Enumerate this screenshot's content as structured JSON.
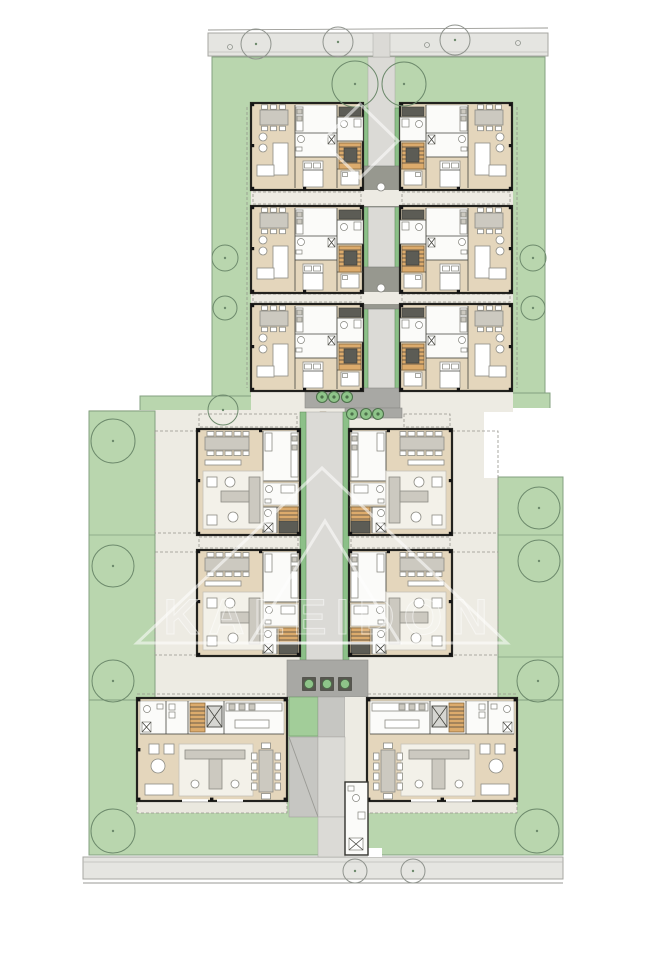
{
  "meta": {
    "title": "Residential complex site plan — ground floor",
    "canvas": {
      "w": 659,
      "h": 960
    }
  },
  "palette": {
    "road": "#e5e5e1",
    "green": "#b9d6ae",
    "trough": "#8cc088",
    "cream": "#edebe3",
    "floor": "#e4d6bc",
    "stair": "#dcab6c",
    "wall": "#22221e",
    "watermark_white": "#ffffff"
  },
  "watermark": {
    "text": "KALEIDON",
    "rhombus": "360,104 398,141 360,178 322,141",
    "triangle_outer": "322,468 507,643 137,643",
    "triangle_inner": "325,521 400,643 250,643",
    "text_x": 330,
    "text_y": 634,
    "font_size": 50,
    "letter_spacing": 9
  },
  "site": {
    "unit_types": {
      "A": {
        "w": 112,
        "h": 87
      },
      "B": {
        "w": 103,
        "h": 106
      },
      "C": {
        "w": 150,
        "h": 103
      }
    },
    "shapes": [
      {
        "t": "line",
        "x1": 208,
        "y1": 30,
        "x2": 548,
        "y2": 28,
        "c": "line",
        "n": "street-edge-top"
      },
      {
        "t": "rect",
        "x": 208,
        "y": 33,
        "w": 340,
        "h": 23,
        "c": "road",
        "n": "sidewalk-top"
      },
      {
        "t": "line",
        "x1": 208,
        "y1": 52,
        "x2": 548,
        "y2": 52,
        "c": "roadline",
        "n": "curb-top"
      },
      {
        "t": "rect",
        "x": 83,
        "y": 857,
        "w": 480,
        "h": 22,
        "c": "road",
        "n": "sidewalk-bottom"
      },
      {
        "t": "line",
        "x1": 83,
        "y1": 862,
        "x2": 563,
        "y2": 862,
        "c": "roadline",
        "n": "curb-bottom"
      },
      {
        "t": "line",
        "x1": 83,
        "y1": 883,
        "x2": 563,
        "y2": 883,
        "c": "line",
        "n": "street-edge-bottom"
      },
      {
        "t": "rect",
        "x": 212,
        "y": 57,
        "w": 333,
        "h": 351,
        "c": "green",
        "n": "garden-top-block"
      },
      {
        "t": "rect",
        "x": 140,
        "y": 396,
        "w": 112,
        "h": 28,
        "c": "green",
        "n": "garden-patch-left"
      },
      {
        "t": "rect",
        "x": 492,
        "y": 393,
        "w": 58,
        "h": 16,
        "c": "green",
        "n": "garden-patch-right"
      },
      {
        "t": "rect",
        "x": 89,
        "y": 410,
        "w": 474,
        "h": 247,
        "c": "cream",
        "n": "court-middle-block"
      },
      {
        "t": "rect",
        "x": 484,
        "y": 408,
        "w": 80,
        "h": 70,
        "c": "white",
        "n": "site-notch-right"
      },
      {
        "t": "rect",
        "x": 137,
        "y": 657,
        "w": 380,
        "h": 43,
        "c": "cream",
        "n": "court-bottom-block"
      },
      {
        "t": "rect",
        "x": 89,
        "y": 411,
        "w": 66,
        "h": 444,
        "c": "green",
        "n": "garden-strip-left"
      },
      {
        "t": "rect",
        "x": 498,
        "y": 477,
        "w": 65,
        "h": 378,
        "c": "green",
        "n": "garden-strip-right"
      },
      {
        "t": "rect",
        "x": 89,
        "y": 700,
        "w": 474,
        "h": 155,
        "c": "green",
        "n": "garden-bottom-block"
      },
      {
        "t": "line",
        "x1": 498,
        "y1": 535,
        "x2": 563,
        "y2": 535,
        "c": "greenline",
        "n": "garden-divider"
      },
      {
        "t": "line",
        "x1": 498,
        "y1": 657,
        "x2": 563,
        "y2": 657,
        "c": "greenline",
        "n": "garden-divider"
      },
      {
        "t": "line",
        "x1": 89,
        "y1": 535,
        "x2": 155,
        "y2": 535,
        "c": "greenline",
        "n": "garden-divider"
      },
      {
        "t": "rect",
        "x": 368,
        "y": 57,
        "w": 27,
        "h": 339,
        "c": "walkL",
        "n": "corridor-top-walk"
      },
      {
        "t": "rect",
        "x": 373,
        "y": 33,
        "w": 17,
        "h": 24,
        "c": "walkL",
        "n": "entry-path-top"
      },
      {
        "t": "rect",
        "x": 363,
        "y": 108,
        "w": 5,
        "h": 283,
        "c": "trough",
        "n": "planting-trough"
      },
      {
        "t": "rect",
        "x": 395,
        "y": 108,
        "w": 5,
        "h": 283,
        "c": "trough",
        "n": "planting-trough"
      },
      {
        "t": "rect",
        "x": 363,
        "y": 166,
        "w": 37,
        "h": 41,
        "c": "dark",
        "n": "stair-landing"
      },
      {
        "t": "rect",
        "x": 363,
        "y": 267,
        "w": 37,
        "h": 42,
        "c": "dark",
        "n": "stair-landing"
      },
      {
        "t": "rect",
        "x": 251,
        "y": 190,
        "w": 262,
        "h": 16,
        "c": "cream",
        "n": "terrace-strip"
      },
      {
        "t": "rect",
        "x": 251,
        "y": 292,
        "w": 262,
        "h": 12,
        "c": "cream",
        "n": "terrace-strip"
      },
      {
        "t": "rect",
        "x": 251,
        "y": 391,
        "w": 262,
        "h": 21,
        "c": "cream",
        "n": "terrace-strip"
      },
      {
        "t": "rect",
        "x": 253,
        "y": 192,
        "w": 108,
        "h": 12,
        "c": "dash",
        "n": "terrace-outline"
      },
      {
        "t": "rect",
        "x": 402,
        "y": 192,
        "w": 108,
        "h": 12,
        "c": "dash",
        "n": "terrace-outline"
      },
      {
        "t": "rect",
        "x": 253,
        "y": 294,
        "w": 108,
        "h": 8,
        "c": "dash",
        "n": "terrace-outline"
      },
      {
        "t": "rect",
        "x": 402,
        "y": 294,
        "w": 108,
        "h": 8,
        "c": "dash",
        "n": "terrace-outline"
      },
      {
        "t": "line",
        "x1": 247,
        "y1": 107,
        "x2": 247,
        "y2": 388,
        "c": "dash",
        "n": "terrace-outline"
      },
      {
        "t": "line",
        "x1": 517,
        "y1": 107,
        "x2": 517,
        "y2": 388,
        "c": "dash",
        "n": "terrace-outline"
      },
      {
        "t": "rect",
        "x": 305,
        "y": 388,
        "w": 95,
        "h": 20,
        "c": "court",
        "n": "entry-plaza-upper"
      },
      {
        "t": "rect",
        "x": 345,
        "y": 408,
        "w": 57,
        "h": 10,
        "c": "court",
        "n": "entry-plaza-lower"
      },
      {
        "t": "rect",
        "x": 320,
        "y": 412,
        "w": 6,
        "h": 18,
        "c": "bench",
        "n": "bench"
      },
      {
        "t": "rect",
        "x": 306,
        "y": 412,
        "w": 37,
        "h": 248,
        "c": "walkL",
        "n": "corridor-middle-walk"
      },
      {
        "t": "rect",
        "x": 300,
        "y": 412,
        "w": 6,
        "h": 248,
        "c": "trough",
        "n": "planting-trough"
      },
      {
        "t": "rect",
        "x": 343,
        "y": 412,
        "w": 6,
        "h": 248,
        "c": "trough",
        "n": "planting-trough"
      },
      {
        "t": "rect",
        "x": 155,
        "y": 431,
        "w": 42,
        "h": 102,
        "c": "dash",
        "n": "terrace-outline"
      },
      {
        "t": "rect",
        "x": 155,
        "y": 552,
        "w": 42,
        "h": 103,
        "c": "dash",
        "n": "terrace-outline"
      },
      {
        "t": "rect",
        "x": 452,
        "y": 431,
        "w": 46,
        "h": 102,
        "c": "dash",
        "n": "terrace-outline"
      },
      {
        "t": "rect",
        "x": 452,
        "y": 552,
        "w": 46,
        "h": 103,
        "c": "dash",
        "n": "terrace-outline"
      },
      {
        "t": "rect",
        "x": 199,
        "y": 537,
        "w": 99,
        "h": 11,
        "c": "dash",
        "n": "terrace-outline"
      },
      {
        "t": "rect",
        "x": 351,
        "y": 537,
        "w": 99,
        "h": 11,
        "c": "dash",
        "n": "terrace-outline"
      },
      {
        "t": "rect",
        "x": 199,
        "y": 414,
        "w": 98,
        "h": 13,
        "c": "dash",
        "n": "terrace-outline"
      },
      {
        "t": "rect",
        "x": 404,
        "y": 414,
        "w": 46,
        "h": 13,
        "c": "dash",
        "n": "terrace-outline"
      },
      {
        "t": "rect",
        "x": 287,
        "y": 660,
        "w": 81,
        "h": 37,
        "c": "court",
        "n": "entry-plaza-bottom"
      },
      {
        "t": "rect",
        "x": 289,
        "y": 697,
        "w": 29,
        "h": 39,
        "c": "gsq",
        "n": "lawn-square"
      },
      {
        "t": "rect",
        "x": 318,
        "y": 697,
        "w": 27,
        "h": 40,
        "c": "walkM",
        "n": "core-paving"
      },
      {
        "t": "rect",
        "x": 345,
        "y": 697,
        "w": 23,
        "h": 85,
        "c": "cream",
        "n": "core-paving"
      },
      {
        "t": "rect",
        "x": 289,
        "y": 737,
        "w": 29,
        "h": 80,
        "c": "walkM",
        "n": "ramp"
      },
      {
        "t": "line",
        "x1": 289,
        "y1": 737,
        "x2": 318,
        "y2": 817,
        "c": "line",
        "n": "ramp-edge"
      },
      {
        "t": "rect",
        "x": 318,
        "y": 737,
        "w": 27,
        "h": 80,
        "c": "walkL",
        "n": "corridor-bottom-walk"
      },
      {
        "t": "rect",
        "x": 318,
        "y": 817,
        "w": 27,
        "h": 40,
        "c": "walkL",
        "n": "entry-path-bottom"
      },
      {
        "t": "rect",
        "x": 368,
        "y": 848,
        "w": 14,
        "h": 9,
        "c": "white",
        "n": "core-niche"
      },
      {
        "t": "rect",
        "x": 137,
        "y": 801,
        "w": 150,
        "h": 12,
        "c": "dashfill",
        "n": "terrace-outline"
      },
      {
        "t": "rect",
        "x": 368,
        "y": 801,
        "w": 149,
        "h": 12,
        "c": "dashfill",
        "n": "terrace-outline"
      },
      {
        "t": "line",
        "x1": 137,
        "y1": 694,
        "x2": 287,
        "y2": 694,
        "c": "dash",
        "n": "terrace-outline"
      },
      {
        "t": "line",
        "x1": 368,
        "y1": 694,
        "x2": 517,
        "y2": 694,
        "c": "dash",
        "n": "terrace-outline"
      },
      {
        "t": "circle",
        "cx": 381,
        "cy": 187,
        "r": 4,
        "c": "landing",
        "n": "skylight"
      },
      {
        "t": "circle",
        "cx": 381,
        "cy": 288,
        "r": 4,
        "c": "landing",
        "n": "skylight"
      }
    ],
    "units": [
      {
        "id": "a1-left",
        "type": "A",
        "x": 251,
        "y": 103,
        "m": false
      },
      {
        "id": "a1-right",
        "type": "A",
        "x": 400,
        "y": 103,
        "m": true
      },
      {
        "id": "a2-left",
        "type": "A",
        "x": 251,
        "y": 206,
        "m": false
      },
      {
        "id": "a2-right",
        "type": "A",
        "x": 400,
        "y": 206,
        "m": true
      },
      {
        "id": "a3-left",
        "type": "A",
        "x": 251,
        "y": 304,
        "m": false
      },
      {
        "id": "a3-right",
        "type": "A",
        "x": 400,
        "y": 304,
        "m": true
      },
      {
        "id": "b1-left",
        "type": "B",
        "x": 197,
        "y": 429,
        "m": false
      },
      {
        "id": "b1-right",
        "type": "B",
        "x": 349,
        "y": 429,
        "m": true
      },
      {
        "id": "b2-left",
        "type": "B",
        "x": 197,
        "y": 550,
        "m": false
      },
      {
        "id": "b2-right",
        "type": "B",
        "x": 349,
        "y": 550,
        "m": true
      },
      {
        "id": "c-left",
        "type": "C",
        "x": 137,
        "y": 698,
        "m": false
      },
      {
        "id": "c-right",
        "type": "C",
        "x": 367,
        "y": 698,
        "m": true
      }
    ],
    "techroom": {
      "x": 345,
      "y": 782
    },
    "trees": [
      {
        "x": 256,
        "y": 44,
        "r": 15,
        "kind": "road"
      },
      {
        "x": 338,
        "y": 42,
        "r": 15,
        "kind": "road"
      },
      {
        "x": 455,
        "y": 40,
        "r": 15,
        "kind": "road"
      },
      {
        "x": 355,
        "y": 871,
        "r": 12,
        "kind": "road"
      },
      {
        "x": 413,
        "y": 871,
        "r": 12,
        "kind": "road"
      },
      {
        "x": 355,
        "y": 84,
        "r": 23,
        "kind": "garden"
      },
      {
        "x": 404,
        "y": 84,
        "r": 22,
        "kind": "garden"
      },
      {
        "x": 225,
        "y": 258,
        "r": 13,
        "kind": "garden"
      },
      {
        "x": 533,
        "y": 258,
        "r": 13,
        "kind": "garden"
      },
      {
        "x": 225,
        "y": 308,
        "r": 12,
        "kind": "garden"
      },
      {
        "x": 533,
        "y": 308,
        "r": 12,
        "kind": "garden"
      },
      {
        "x": 223,
        "y": 410,
        "r": 15,
        "kind": "garden"
      },
      {
        "x": 113,
        "y": 441,
        "r": 22,
        "kind": "garden"
      },
      {
        "x": 113,
        "y": 566,
        "r": 21,
        "kind": "garden"
      },
      {
        "x": 113,
        "y": 681,
        "r": 21,
        "kind": "garden"
      },
      {
        "x": 113,
        "y": 831,
        "r": 22,
        "kind": "garden"
      },
      {
        "x": 539,
        "y": 508,
        "r": 21,
        "kind": "garden"
      },
      {
        "x": 539,
        "y": 561,
        "r": 21,
        "kind": "garden"
      },
      {
        "x": 538,
        "y": 681,
        "r": 21,
        "kind": "garden"
      },
      {
        "x": 537,
        "y": 831,
        "r": 22,
        "kind": "garden"
      }
    ],
    "manholes": [
      {
        "x": 230,
        "y": 47
      },
      {
        "x": 427,
        "y": 45
      },
      {
        "x": 518,
        "y": 43
      }
    ],
    "planters_round": [
      {
        "x": 322,
        "y": 397
      },
      {
        "x": 334,
        "y": 397
      },
      {
        "x": 347,
        "y": 397
      },
      {
        "x": 352,
        "y": 414
      },
      {
        "x": 366,
        "y": 414
      },
      {
        "x": 378,
        "y": 414
      }
    ],
    "planters_square": [
      {
        "x": 309,
        "y": 684
      },
      {
        "x": 327,
        "y": 684
      },
      {
        "x": 345,
        "y": 684
      }
    ]
  }
}
